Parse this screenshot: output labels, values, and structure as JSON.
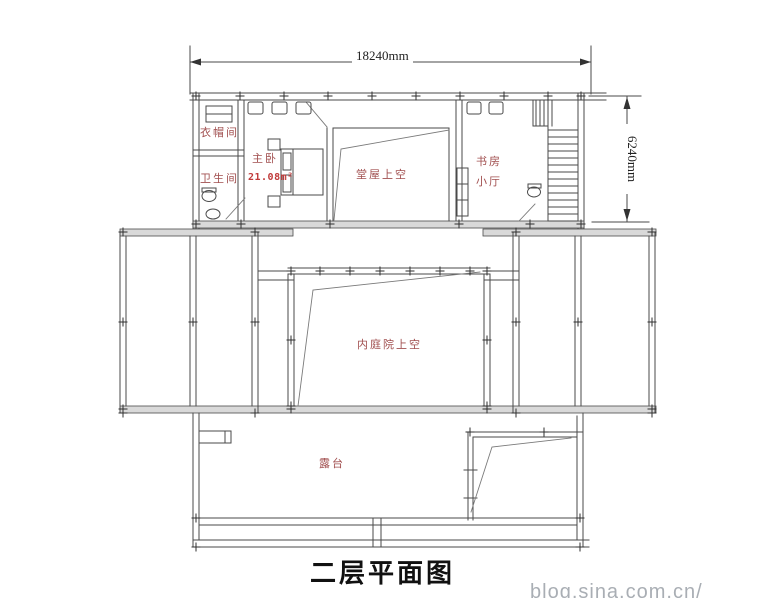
{
  "drawing": {
    "title": "二层平面图",
    "dimensions": {
      "width_label": "18240mm",
      "height_label": "6240mm"
    },
    "rooms": {
      "cloakroom": "衣帽间",
      "bathroom": "卫生间",
      "master_bedroom": "主卧",
      "master_bedroom_area": "21.08m²",
      "hall_void": "堂屋上空",
      "study": "书房",
      "small_hall": "小厅",
      "courtyard_void": "内庭院上空",
      "terrace": "露台"
    },
    "watermark": "blog.sina.com.cn/",
    "colors": {
      "room_label": "#a14f4f",
      "area_label": "#c03a3a",
      "line": "#4a4a4a",
      "wall_fill": "#d9d9d9",
      "title_text": "#111111",
      "watermark_text": "#a9aeb4"
    }
  }
}
